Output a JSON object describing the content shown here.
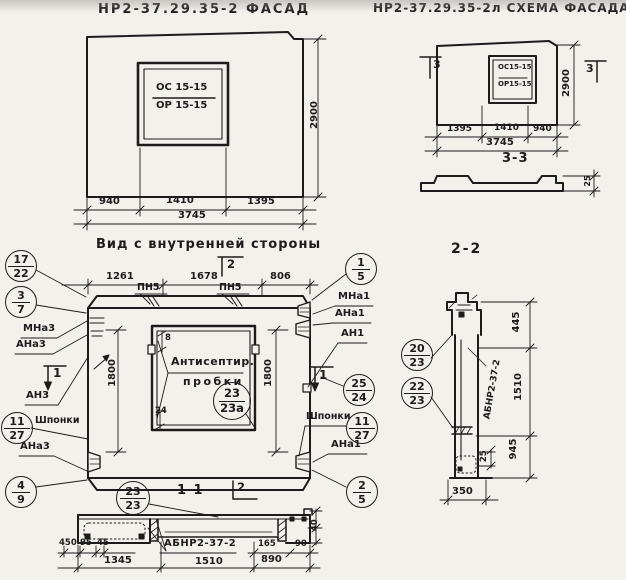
{
  "colors": {
    "paper": "#f3f1ec",
    "ink": "#1c1c1c"
  },
  "facade": {
    "title": "НР2-37.29.35-2 ФАСАД",
    "window": {
      "top": "ОС 15-15",
      "bottom": "ОР 15-15"
    },
    "dims": {
      "w1": "940",
      "w2": "1410",
      "w3": "1395",
      "total": "3745",
      "height": "2900"
    }
  },
  "scheme": {
    "title": "НР2-37.29.35-2л СХЕМА ФАСАДА",
    "window": {
      "top": "ОС15-15",
      "bottom": "ОР15-15"
    },
    "flag_left": "3",
    "flag_right": "3",
    "dims": {
      "w1": "1395",
      "w2": "1410",
      "w3": "940",
      "total": "3745",
      "height": "2900"
    },
    "section": {
      "title": "3-3",
      "thickness": "25"
    }
  },
  "inner": {
    "title": "Вид с внутренней стороны",
    "flag_top": "2",
    "dims": {
      "t1": "1261",
      "t2": "1678",
      "t3": "806",
      "left": "1800",
      "right": "1800",
      "corner_top": "8",
      "corner_bottom": "24"
    },
    "pn_left": "ПН5",
    "pn_right": "ПН5",
    "note_line1": "Антисептир.",
    "note_line2": "пробки",
    "callout_center": {
      "top": "23",
      "bottom": "23а"
    },
    "left": {
      "c1": {
        "top": "17",
        "bottom": "22"
      },
      "c2": {
        "top": "3",
        "bottom": "7"
      },
      "c3": {
        "top": "11",
        "bottom": "27"
      },
      "c4": {
        "top": "4",
        "bottom": "9"
      },
      "l1": "МНа3",
      "l2": "АНа3",
      "l3": "АН3",
      "l4": "АНа3",
      "flag": "1",
      "keys": "Шпонки"
    },
    "right": {
      "c1": {
        "top": "1",
        "bottom": "5"
      },
      "c2": {
        "top": "25",
        "bottom": "24"
      },
      "c3": {
        "top": "11",
        "bottom": "27"
      },
      "c4": {
        "top": "2",
        "bottom": "5"
      },
      "l1": "МНа1",
      "l2": "АНа1",
      "l3": "АН1",
      "l4": "АНа1",
      "flag": "1",
      "keys": "Шпонки"
    }
  },
  "s11": {
    "title": "1-1",
    "flag": "2",
    "callout": {
      "top": "23",
      "bottom": "23"
    },
    "label": "АБНР2-37-2",
    "dims": {
      "a1": "450",
      "a2": "95",
      "a3": "45",
      "b1": "1345",
      "b2": "1510",
      "b3": "890",
      "r1": "165",
      "r2": "90",
      "v1": "40"
    }
  },
  "s22": {
    "title": "2-2",
    "c1": {
      "top": "20",
      "bottom": "23"
    },
    "c2": {
      "top": "22",
      "bottom": "23"
    },
    "label": "АБНР2-37-2",
    "dims": {
      "h1": "445",
      "h2": "1510",
      "h3": "945",
      "step": "25",
      "bottom": "350"
    }
  }
}
